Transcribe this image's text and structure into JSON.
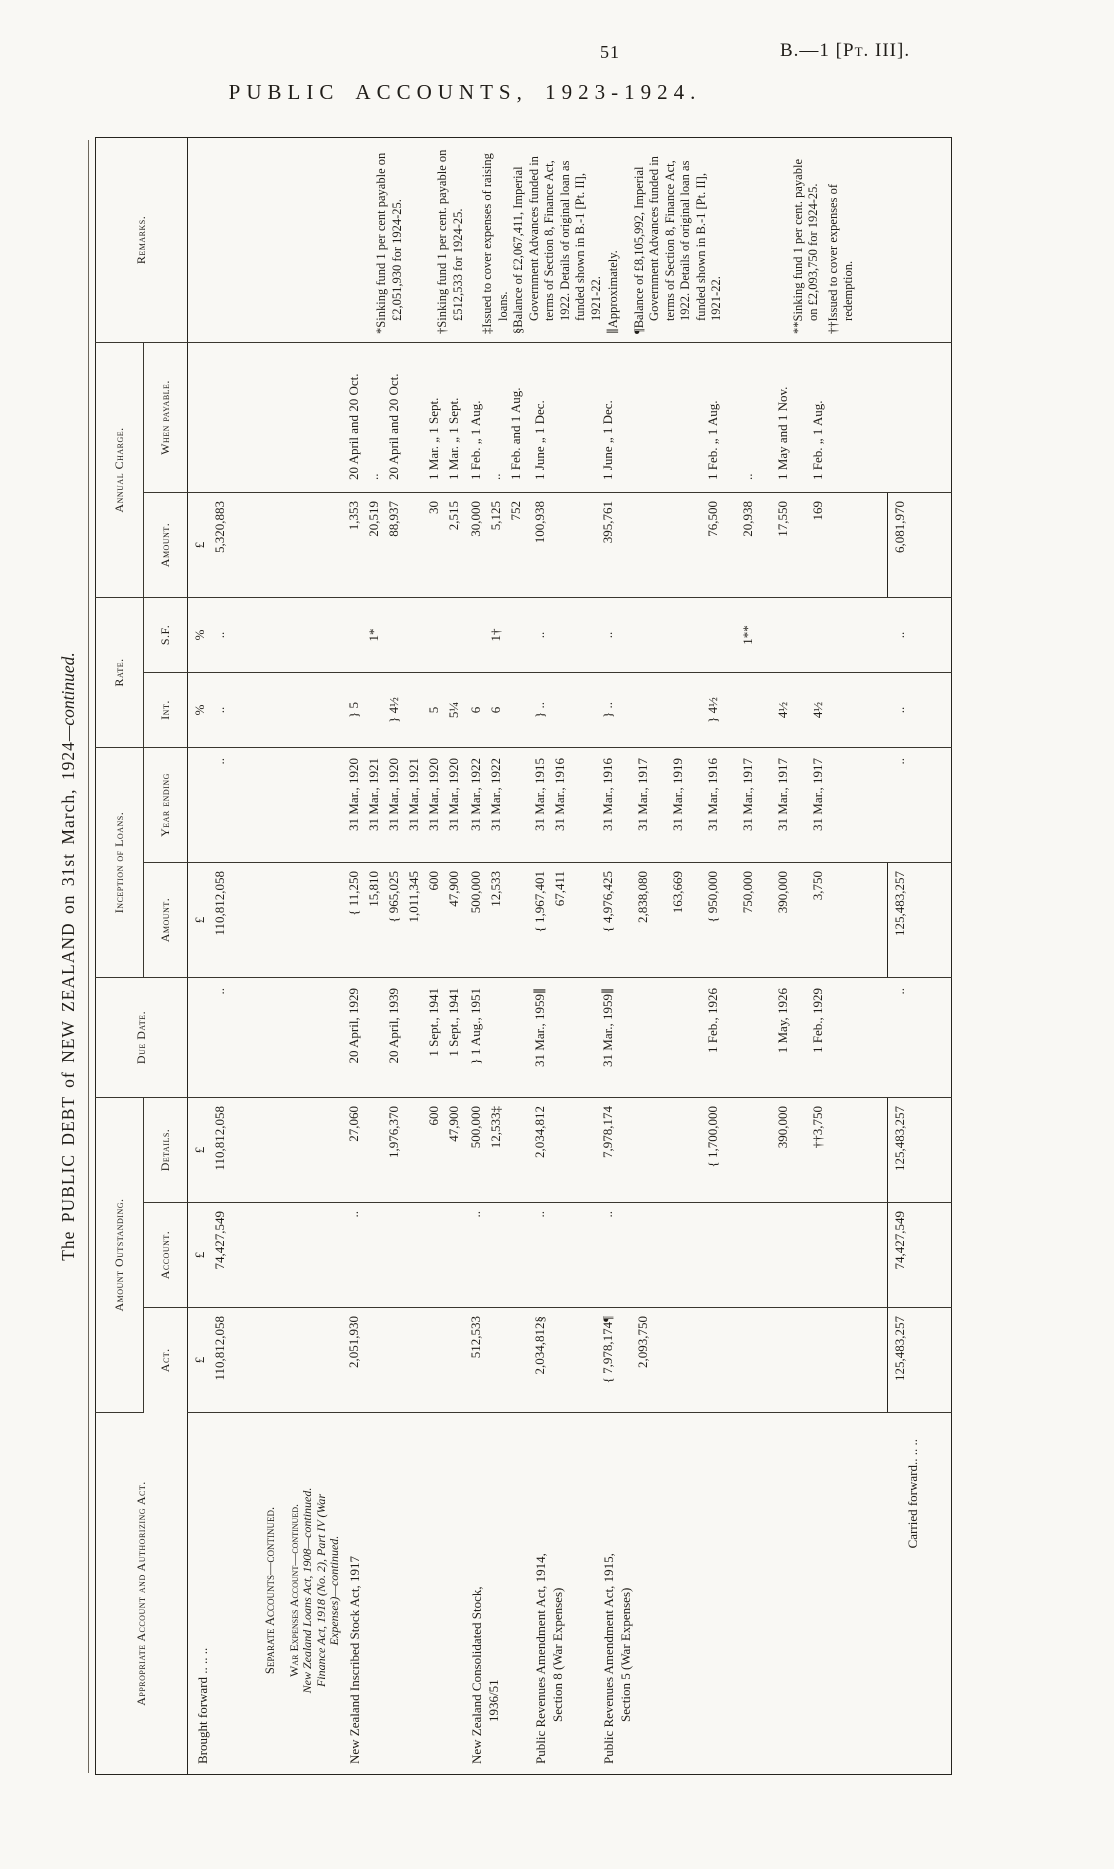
{
  "page": {
    "number": "51",
    "doc_ref": "B.—1 [Pt. III].",
    "title": "PUBLIC ACCOUNTS, 1923-1924.",
    "table_title": "The PUBLIC DEBT of NEW ZEALAND on 31st March, 1924",
    "table_title_suffix": "—continued."
  },
  "header": {
    "appropriate": "Appropriate Account and Authorizing Act.",
    "amount_outstanding": "Amount Outstanding.",
    "act": "Act.",
    "account": "Account.",
    "details": "Details.",
    "due_date": "Due Date.",
    "inception": "Inception of Loans.",
    "inc_amount": "Amount.",
    "year_ending": "Year ending",
    "rate": "Rate.",
    "int": "Int.",
    "sf": "S.F.",
    "annual_charge": "Annual Charge.",
    "ann_amount": "Amount.",
    "when_payable": "When payable.",
    "remarks": "Remarks."
  },
  "rows": [
    {
      "name": "brought-forward",
      "approp_lines": [
        "Brought forward  ..  ..  .."
      ],
      "lines": [
        {
          "act": "£",
          "account": "£",
          "details": "£",
          "inc": "£",
          "int": "%",
          "sf": "%",
          "ann": "£"
        },
        {
          "act": "110,812,058",
          "account": "74,427,549",
          "details": "110,812,058",
          "due": "..",
          "inc": "110,812,058",
          "year": "..",
          "int": "..",
          "sf": "..",
          "ann": "5,320,883"
        }
      ]
    },
    {
      "name": "separate-accounts-heading",
      "approp_lines": [
        "Separate Accounts—continued."
      ],
      "lines": []
    },
    {
      "name": "war-expenses-heading",
      "approp_lines": [
        "War Expenses Account—continued.",
        "New Zealand Loans Act, 1908—continued.",
        "Finance Act, 1918 (No. 2), Part IV (War",
        "Expenses)—continued."
      ],
      "lines": []
    },
    {
      "name": "nz-inscribed-stock-act-1917",
      "approp_lines": [
        "New Zealand Inscribed Stock Act, 1917"
      ],
      "lines": [
        {
          "act": "2,051,930",
          "account": "..",
          "details": "27,060",
          "due": "20 April, 1929",
          "inc": "{ 11,250",
          "year": "31 Mar., 1920",
          "int": "} 5",
          "ann": "1,353",
          "when": "20 April and 20 Oct."
        },
        {
          "inc": "15,810",
          "year": "31 Mar., 1921",
          "sf": "1*",
          "ann": "20,519",
          "when": ".."
        },
        {
          "details": "1,976,370",
          "due": "20 April, 1939",
          "inc": "{ 965,025",
          "year": "31 Mar., 1920",
          "int": "} 4½",
          "ann": "88,937",
          "when": "20 April and 20 Oct."
        },
        {
          "inc": "1,011,345",
          "year": "31 Mar., 1921"
        },
        {
          "details": "600",
          "due": "1 Sept., 1941",
          "inc": "600",
          "year": "31 Mar., 1920",
          "int": "5",
          "ann": "30",
          "when": "1 Mar. „ 1 Sept."
        },
        {
          "details": "47,900",
          "due": "1 Sept., 1941",
          "inc": "47,900",
          "year": "31 Mar., 1920",
          "int": "5¼",
          "ann": "2,515",
          "when": "1 Mar. „ 1 Sept."
        }
      ]
    },
    {
      "name": "nz-consolidated-stock-1936-51",
      "approp_lines": [
        "New Zealand Consolidated Stock,",
        "1936/51"
      ],
      "lines": [
        {
          "act": "512,533",
          "account": "..",
          "details": "500,000",
          "due": "} 1 Aug., 1951",
          "inc": "500,000",
          "year": "31 Mar., 1922",
          "int": "6",
          "ann": "30,000",
          "when": "1 Feb. „ 1 Aug."
        },
        {
          "details": "12,533‡",
          "inc": "12,533",
          "year": "31 Mar., 1922",
          "int": "6",
          "sf": "1†",
          "ann": "5,125",
          "when": ".."
        },
        {
          "ann": "752",
          "when": "1 Feb. and 1 Aug."
        }
      ]
    },
    {
      "name": "public-revenues-amendment-act-1914",
      "approp_lines": [
        "Public Revenues Amendment Act, 1914,",
        "Section 8 (War Expenses)"
      ],
      "lines": [
        {
          "act": "2,034,812§",
          "account": "..",
          "details": "2,034,812",
          "due": "31 Mar., 1959∥",
          "inc": "{ 1,967,401",
          "year": "31 Mar., 1915",
          "int": "} ..",
          "sf": "..",
          "ann": "100,938",
          "when": "1 June „ 1 Dec."
        },
        {
          "inc": "67,411",
          "year": "31 Mar., 1916"
        }
      ]
    },
    {
      "name": "public-revenues-amendment-act-1915",
      "approp_lines": [
        "Public Revenues Amendment Act, 1915,",
        "Section 5 (War Expenses)"
      ],
      "lines": [
        {
          "act": "{ 7,978,174¶",
          "account": "..",
          "details": "7,978,174",
          "due": "31 Mar., 1959∥",
          "inc": "{ 4,976,425",
          "year": "31 Mar., 1916",
          "int": "} ..",
          "sf": "..",
          "ann": "395,761",
          "when": "1 June „ 1 Dec."
        },
        {
          "act": "2,093,750",
          "inc": "2,838,080",
          "year": "31 Mar., 1917"
        },
        {
          "inc": "163,669",
          "year": "31 Mar., 1919"
        },
        {
          "details": "{ 1,700,000",
          "due": "1 Feb., 1926",
          "inc": "{ 950,000",
          "year": "31 Mar., 1916",
          "int": "} 4½",
          "ann": "76,500",
          "when": "1 Feb. „ 1 Aug."
        },
        {
          "inc": "750,000",
          "year": "31 Mar., 1917",
          "sf": "1**",
          "ann": "20,938",
          "when": ".."
        },
        {
          "details": "390,000",
          "due": "1 May, 1926",
          "inc": "390,000",
          "year": "31 Mar., 1917",
          "int": "4½",
          "ann": "17,550",
          "when": "1 May and 1 Nov."
        },
        {
          "details": "††3,750",
          "due": "1 Feb., 1929",
          "inc": "3,750",
          "year": "31 Mar., 1917",
          "int": "4½",
          "ann": "169",
          "when": "1 Feb. „ 1 Aug."
        }
      ]
    },
    {
      "name": "carried-forward",
      "approp_lines": [
        "Carried forward..  ..  .."
      ],
      "lines": [
        {
          "act": "125,483,257",
          "account": "74,427,549",
          "details": "125,483,257",
          "due": "..",
          "inc": "125,483,257",
          "year": "..",
          "int": "..",
          "sf": "..",
          "ann": "6,081,970"
        }
      ]
    }
  ],
  "footnotes": [
    "*Sinking fund 1 per cent payable on £2,051,930 for 1924-25.",
    "†Sinking fund 1 per cent. payable on £512,533 for 1924-25.",
    "‡Issued to cover expenses of raising loans.",
    "§Balance of £2,067,411, Imperial Government Advances funded in terms of Section 8, Finance Act, 1922. Details of original loan as funded shown in B.-1 [Pt. II], 1921-22.",
    "∥Approximately.",
    "¶Balance of £8,105,992, Imperial Government Advances funded in terms of Section 8, Finance Act, 1922. Details of original loan as funded shown in B.-1 [Pt. II], 1921-22.",
    "**Sinking fund 1 per cent. payable on £2,093,750 for 1924-25.",
    "††Issued to cover expenses of redemption."
  ]
}
